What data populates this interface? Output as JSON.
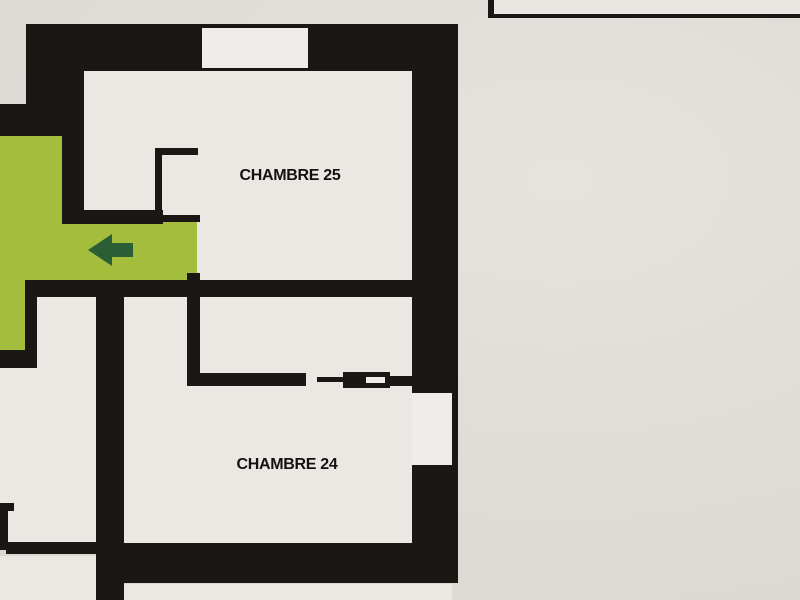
{
  "floor_plan": {
    "rooms": [
      {
        "id": "chambre-25",
        "label": "CHAMBRE 25"
      },
      {
        "id": "chambre-24",
        "label": "CHAMBRE 24"
      }
    ],
    "corridor": {
      "arrow_direction": "left"
    },
    "colors": {
      "wall": "#1a1714",
      "paper": "#e4e1db",
      "room": "#eae8e3",
      "opening": "#eeedea",
      "green": "#a4bd3c",
      "arrow": "#2b5e34",
      "frame": "#e9e7e2"
    }
  }
}
